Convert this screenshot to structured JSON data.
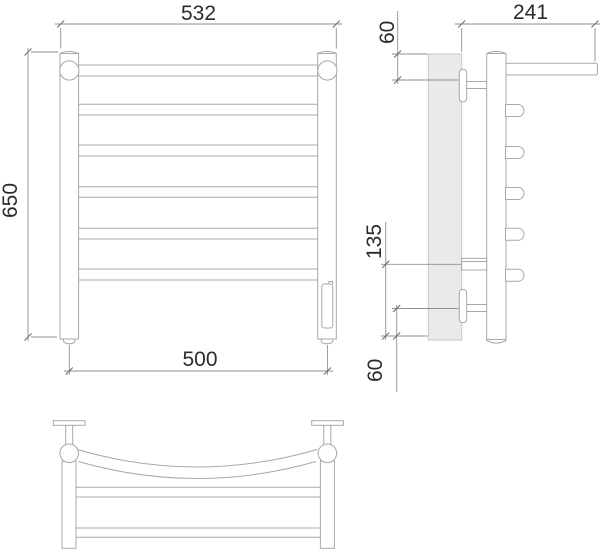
{
  "drawing": {
    "type": "technical-drawing-towel-rail",
    "dimensions": {
      "front_overall_width": {
        "value": "532"
      },
      "front_height": {
        "value": "650"
      },
      "front_center_width": {
        "value": "500"
      },
      "side_depth": {
        "value": "241"
      },
      "side_top_offset": {
        "value": "60"
      },
      "side_lower_span": {
        "value": "135"
      },
      "side_bottom_offset": {
        "value": "60"
      }
    },
    "colors": {
      "outline": "#a8a8a8",
      "dimension_line": "#8f8f8f",
      "text": "#2b2b2b",
      "wall_fill": "#eaeaec",
      "background": "#ffffff"
    }
  }
}
